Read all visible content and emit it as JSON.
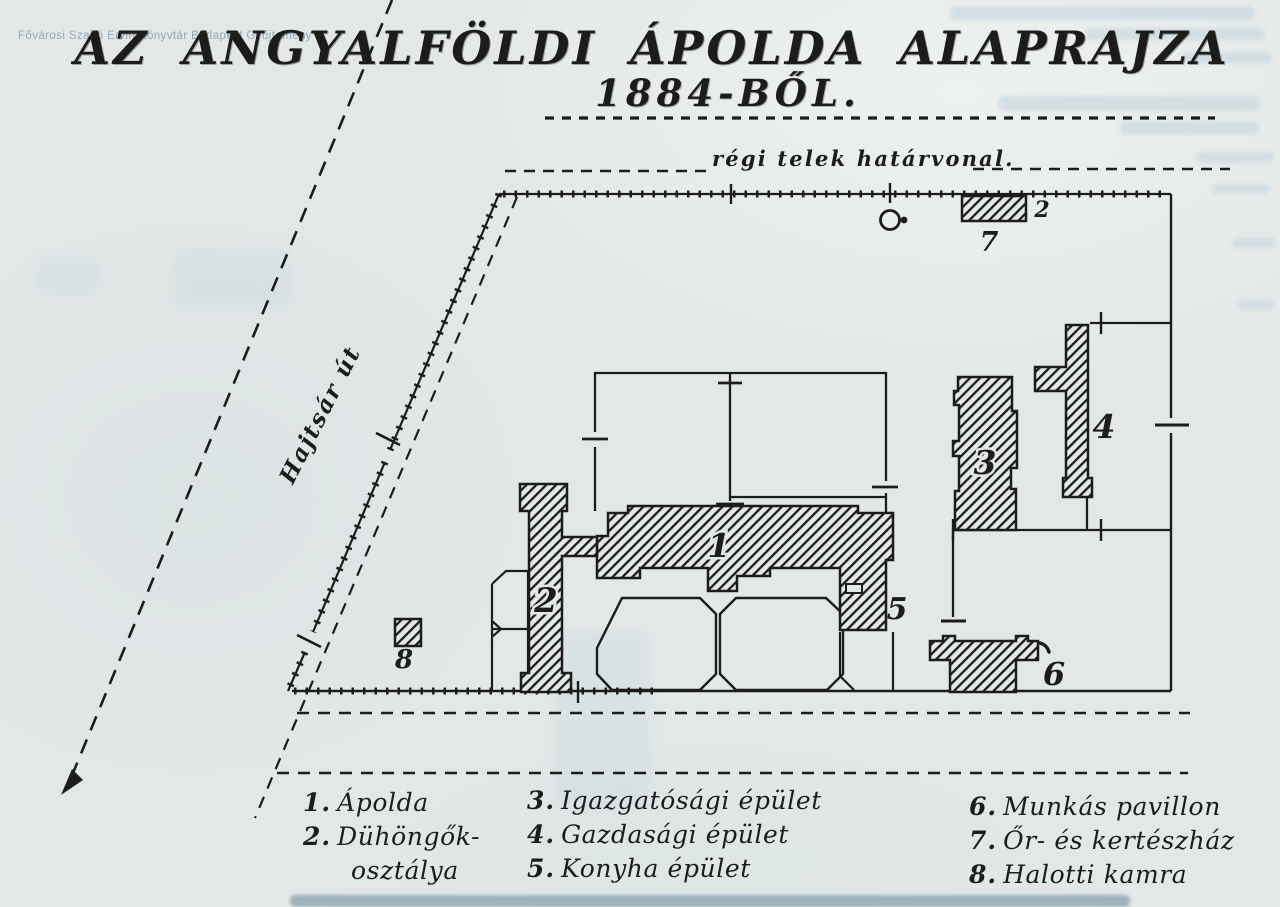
{
  "watermark": "Fővárosi Szabó Ervin Könyvtár Budapest Gyűjtemény",
  "title": {
    "line1": "AZ ANGYALFÖLDI ÁPOLDA ALAPRAJZA",
    "line2": "1884-BŐL."
  },
  "plan": {
    "boundary_label": "régi telek határvonal.",
    "street_label": "Hajtsár út",
    "numbers": {
      "n1": "1",
      "n2": "2",
      "n3": "3",
      "n4": "4",
      "n5": "5",
      "n6": "6",
      "n7": "7",
      "n8": "8",
      "plot": "2"
    }
  },
  "legend": {
    "items": [
      {
        "num": "1.",
        "label": "Ápolda"
      },
      {
        "num": "2.",
        "label": "Dühöngők-",
        "cont": "osztálya"
      },
      {
        "num": "3.",
        "label": "Igazgatósági épület"
      },
      {
        "num": "4.",
        "label": "Gazdasági épület"
      },
      {
        "num": "5.",
        "label": "Konyha épület"
      },
      {
        "num": "6.",
        "label": "Munkás pavillon"
      },
      {
        "num": "7.",
        "label": "Őr- és kertészház"
      },
      {
        "num": "8.",
        "label": "Halotti kamra"
      }
    ]
  },
  "colors": {
    "ink": "#1c1c1b",
    "paper": "#e3e8e7",
    "ghost": "#c6d6de"
  }
}
